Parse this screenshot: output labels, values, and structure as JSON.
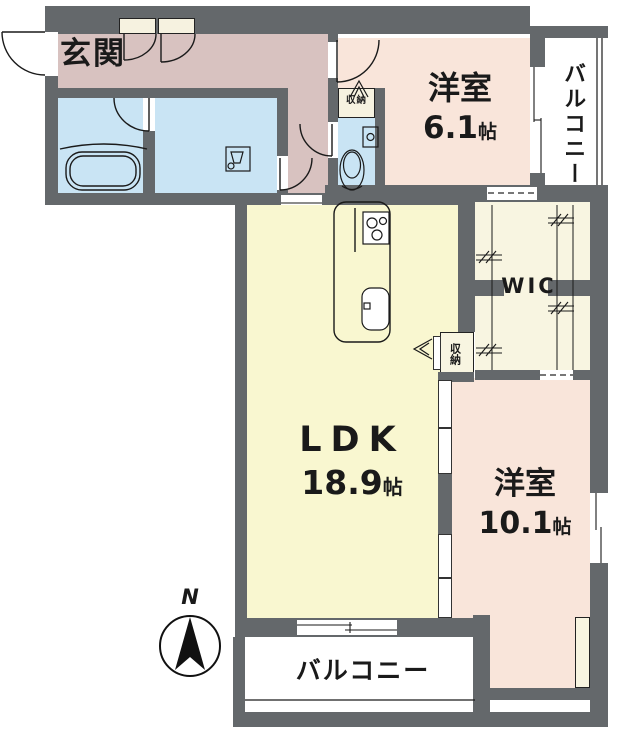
{
  "plan_type": "apartment-floor-plan",
  "rooms": {
    "entrance": {
      "label": "玄関"
    },
    "western_room_1": {
      "label": "洋室",
      "size": "6.1",
      "size_unit": "帖"
    },
    "western_room_2": {
      "label": "洋室",
      "size": "10.1",
      "size_unit": "帖"
    },
    "ldk": {
      "label": "LDK",
      "size": "18.9",
      "size_unit": "帖"
    },
    "wic": {
      "label": "WIC"
    },
    "balcony_right": {
      "label": "バルコニー"
    },
    "balcony_bottom": {
      "label": "バルコニー"
    },
    "hall_storage": {
      "label": "収納"
    },
    "ldk_storage": {
      "label": "収納"
    }
  },
  "compass": {
    "north_label": "N"
  },
  "colors": {
    "wall": "#64686b",
    "hall_floor": "#d8c2c0",
    "western_room_floor": "#f9e5da",
    "ldk_floor": "#f9f7d0",
    "wet_area_floor": "#c9e4f4",
    "wic_floor": "#f8f5e1",
    "storage_fill": "#f6f2e0",
    "balcony_floor": "#ffffff",
    "outline": "#222222"
  }
}
